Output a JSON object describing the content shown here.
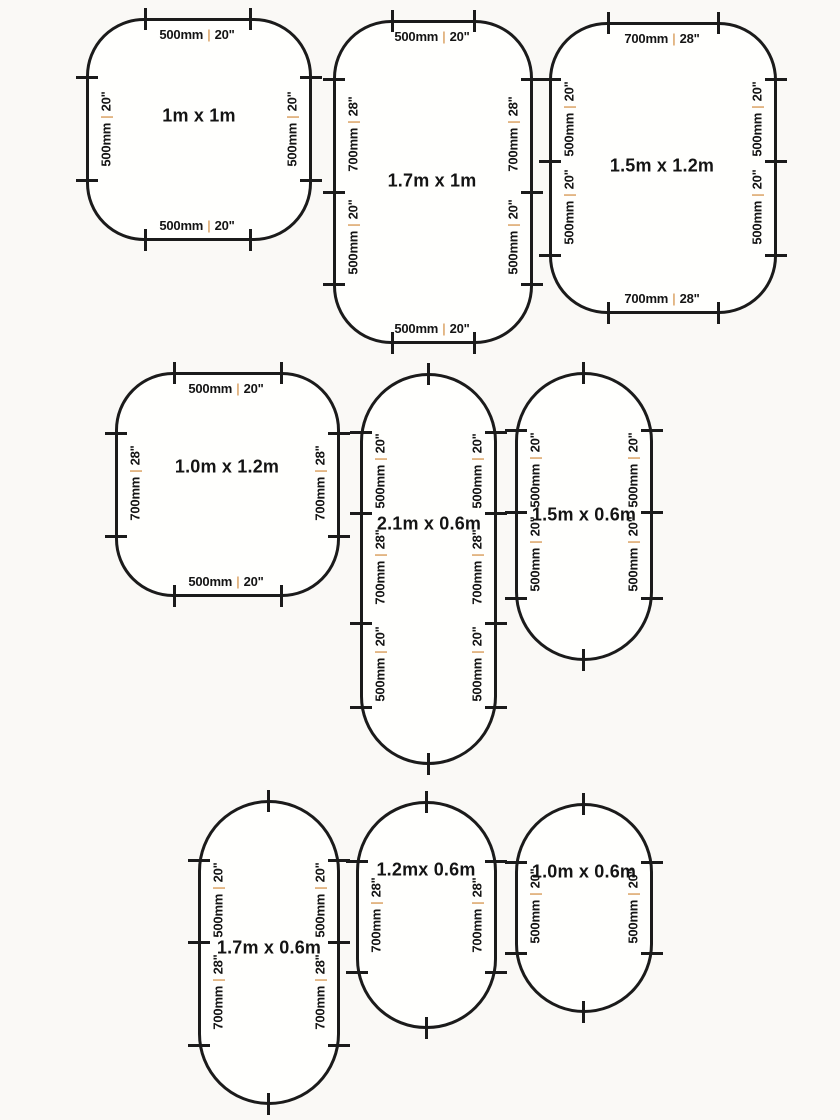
{
  "separator": "|",
  "colors": {
    "line": "#1b1b1b",
    "separator": "#dfad76",
    "text": "#141414"
  },
  "shapes": [
    {
      "title": "1m x 1m",
      "top": {
        "mm": "500mm",
        "in": "20\""
      },
      "bottom": {
        "mm": "500mm",
        "in": "20\""
      },
      "left": [
        {
          "mm": "500mm",
          "in": "20\""
        }
      ],
      "right": [
        {
          "mm": "500mm",
          "in": "20\""
        }
      ]
    },
    {
      "title": "1.7m x 1m",
      "top": {
        "mm": "500mm",
        "in": "20\""
      },
      "bottom": {
        "mm": "500mm",
        "in": "20\""
      },
      "left": [
        {
          "mm": "700mm",
          "in": "28\""
        },
        {
          "mm": "500mm",
          "in": "20\""
        }
      ],
      "right": [
        {
          "mm": "700mm",
          "in": "28\""
        },
        {
          "mm": "500mm",
          "in": "20\""
        }
      ]
    },
    {
      "title": "1.5m x 1.2m",
      "top": {
        "mm": "700mm",
        "in": "28\""
      },
      "bottom": {
        "mm": "700mm",
        "in": "28\""
      },
      "left": [
        {
          "mm": "500mm",
          "in": "20\""
        },
        {
          "mm": "500mm",
          "in": "20\""
        }
      ],
      "right": [
        {
          "mm": "500mm",
          "in": "20\""
        },
        {
          "mm": "500mm",
          "in": "20\""
        }
      ]
    },
    {
      "title": "1.0m x 1.2m",
      "top": {
        "mm": "500mm",
        "in": "20\""
      },
      "bottom": {
        "mm": "500mm",
        "in": "20\""
      },
      "left": [
        {
          "mm": "700mm",
          "in": "28\""
        }
      ],
      "right": [
        {
          "mm": "700mm",
          "in": "28\""
        }
      ]
    },
    {
      "title": "2.1m x 0.6m",
      "left": [
        {
          "mm": "500mm",
          "in": "20\""
        },
        {
          "mm": "700mm",
          "in": "28\""
        },
        {
          "mm": "500mm",
          "in": "20\""
        }
      ],
      "right": [
        {
          "mm": "500mm",
          "in": "20\""
        },
        {
          "mm": "700mm",
          "in": "28\""
        },
        {
          "mm": "500mm",
          "in": "20\""
        }
      ]
    },
    {
      "title": "1.5m x 0.6m",
      "left": [
        {
          "mm": "500mm",
          "in": "20\""
        },
        {
          "mm": "500mm",
          "in": "20\""
        }
      ],
      "right": [
        {
          "mm": "500mm",
          "in": "20\""
        },
        {
          "mm": "500mm",
          "in": "20\""
        }
      ]
    },
    {
      "title": "1.7m x 0.6m",
      "left": [
        {
          "mm": "500mm",
          "in": "20\""
        },
        {
          "mm": "700mm",
          "in": "28\""
        }
      ],
      "right": [
        {
          "mm": "500mm",
          "in": "20\""
        },
        {
          "mm": "700mm",
          "in": "28\""
        }
      ]
    },
    {
      "title": "1.2mx 0.6m",
      "left": [
        {
          "mm": "700mm",
          "in": "28\""
        }
      ],
      "right": [
        {
          "mm": "700mm",
          "in": "28\""
        }
      ]
    },
    {
      "title": "1.0m x 0.6m",
      "left": [
        {
          "mm": "500mm",
          "in": "20\""
        }
      ],
      "right": [
        {
          "mm": "500mm",
          "in": "20\""
        }
      ]
    }
  ]
}
